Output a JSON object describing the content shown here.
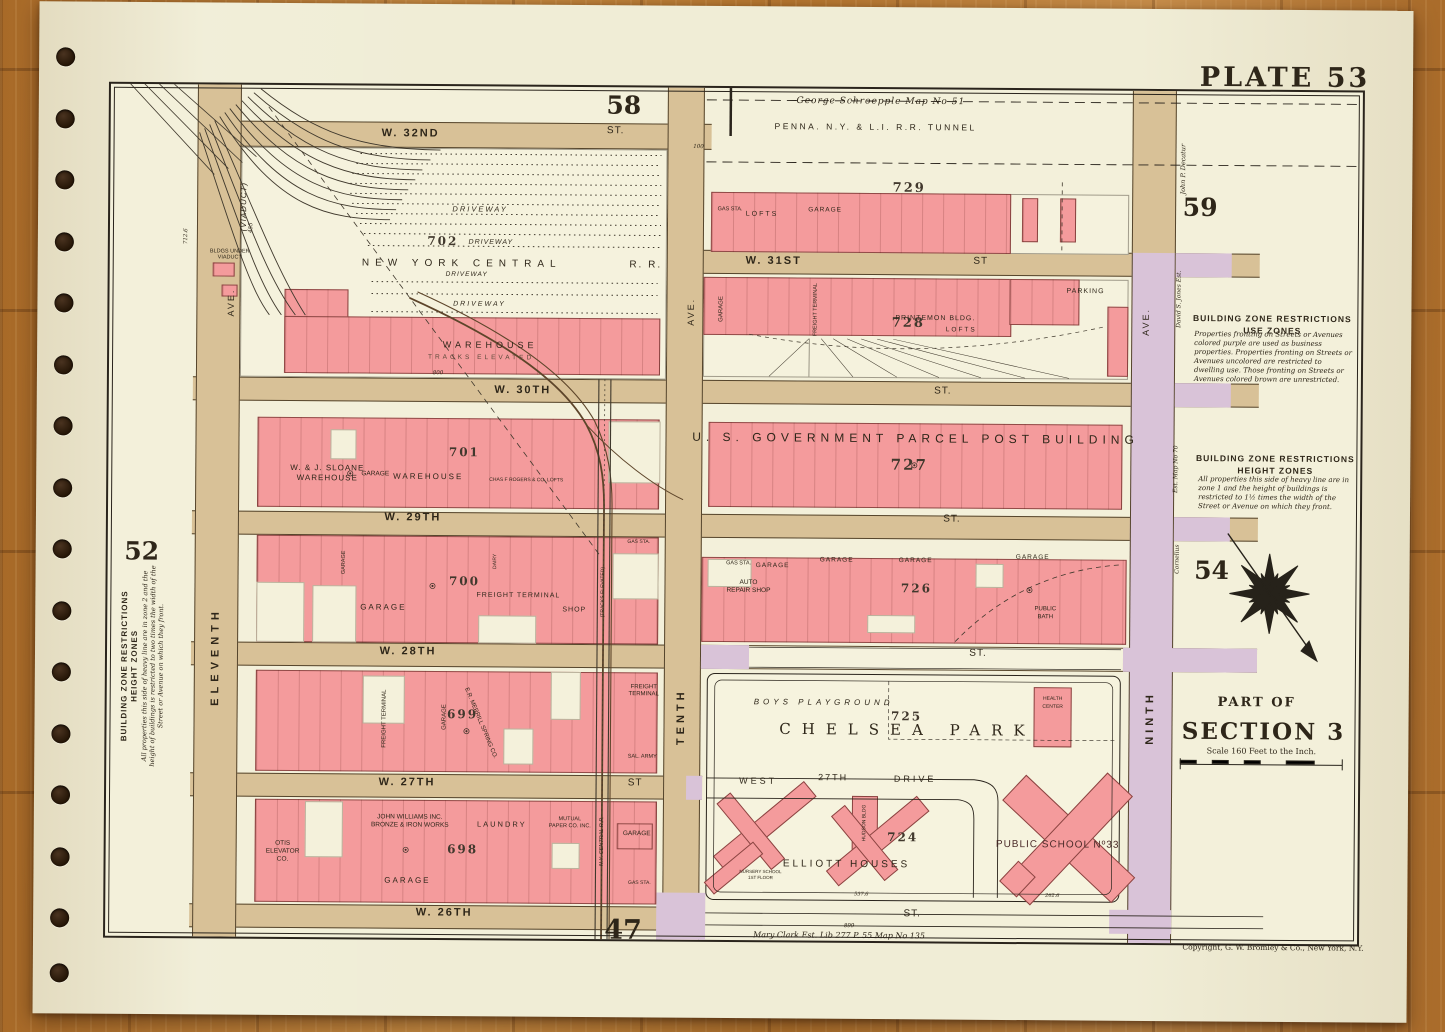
{
  "colors": {
    "paper": "#f0edd6",
    "pink": "#f49b9c",
    "tan": "#d8c197",
    "purple": "#d9c3d8",
    "ink": "#2a241c",
    "wood": "#b5762f"
  },
  "plate": {
    "title": "PLATE 53",
    "copyright": "Copyright, G. W. Bromley & Co., New York, N.Y."
  },
  "adjacent": {
    "top": "58",
    "topright": "59",
    "left": "52",
    "right": "54",
    "bottom": "47"
  },
  "margin": {
    "schroepple": "George Schroepple Map No 51",
    "tunnel": "PENNA. N.Y. & L.I. R.R. TUNNEL",
    "maryclark": "Mary Clark Est. Lib 277 P. 55 Map No 135",
    "decatur": "John P. Decatur",
    "jones": "David S. Jones Est.",
    "cornelius": "Cornelius",
    "estmap": "Est. Map No 70"
  },
  "zones": {
    "use": {
      "t1": "BUILDING ZONE RESTRICTIONS",
      "t2": "USE ZONES",
      "body": "Properties fronting on Streets or Avenues colored purple are used as business properties. Properties fronting on Streets or Avenues uncolored are restricted to dwelling use. Those fronting on Streets or Avenues colored brown are unrestricted."
    },
    "height": {
      "t1": "BUILDING ZONE RESTRICTIONS",
      "t2": "HEIGHT ZONES",
      "body": "All properties this side of heavy line are in zone 1 and the height of buildings is restricted to 1½ times the width of the Street or Avenue on which they front."
    },
    "left": {
      "t1": "BUILDING ZONE RESTRICTIONS",
      "t2": "HEIGHT ZONES",
      "body": "All properties this side of heavy line are in zone 2 and the height of buildings is restricted to two times the width of the Street or Avenue on which they front."
    }
  },
  "section": {
    "partof": "PART OF",
    "name": "SECTION 3",
    "scale": "Scale 160 Feet to the Inch."
  },
  "streets": {
    "w32": "W. 32ND",
    "w31": "W. 31ST",
    "w30": "W. 30TH",
    "w29": "W. 29TH",
    "w28": "W. 28TH",
    "w27": "W. 27TH",
    "w26": "W. 26TH",
    "st": "ST.",
    "st2": "ST"
  },
  "aves": {
    "eleventh": "ELEVENTH",
    "tenth": "TENTH",
    "ninth": "NINTH",
    "ave": "AVE.",
    "viaduct": "(VIADUCT)"
  },
  "yard": {
    "num": "702",
    "rr1": "NEW YORK CENTRAL",
    "rr2": "R. R.",
    "driveway": "DRIVEWAY",
    "warehouse": "WAREHOUSE",
    "tracks": "TRACKS ELEVATED",
    "bldgs": "BLDGS UNDER VIADUCT"
  },
  "b729": {
    "num": "729",
    "gas": "GAS STA.",
    "lofts": "LOFTS",
    "garage": "GARAGE"
  },
  "b728": {
    "num": "728",
    "garage": "GARAGE",
    "freight": "FREIGHT TERMINAL",
    "printemon": "PRINTEMON BLDG.",
    "lofts": "LOFTS",
    "parking": "PARKING"
  },
  "b727": {
    "num": "727",
    "name": "U. S. GOVERNMENT PARCEL POST BUILDING"
  },
  "b701": {
    "num": "701",
    "sloane1": "W. & J. SLOANE",
    "sloane2": "WAREHOUSE",
    "garage": "GARAGE",
    "warehouse": "WAREHOUSE",
    "rogers": "CHAS F ROGERS & CO. LOFTS"
  },
  "b700": {
    "num": "700",
    "garage1": "GARAGE",
    "garage2": "GARAGE",
    "dairy": "DAIRY",
    "freight": "FREIGHT TERMINAL",
    "shop": "SHOP",
    "gas": "GAS STA.",
    "tracks": "(TRACKS ELEVATED)"
  },
  "b726": {
    "num": "726",
    "gas": "GAS STA.",
    "auto1": "AUTO",
    "auto2": "REPAIR SHOP",
    "garage": "GARAGE",
    "bath1": "PUBLIC",
    "bath2": "BATH"
  },
  "b699": {
    "num": "699",
    "freight": "FREIGHT TERMINAL",
    "garage": "GARAGE",
    "merrill": "E.R. MERRILL SPRING CO.",
    "freight2": "FREIGHT TERMINAL",
    "sal": "SAL. ARMY"
  },
  "park": {
    "num": "725",
    "name": "CHELSEA PARK",
    "playground": "BOYS PLAYGROUND",
    "health1": "HEALTH",
    "health2": "CENTER",
    "west": "WEST",
    "d27": "27TH",
    "drive": "DRIVE"
  },
  "b724": {
    "num": "724",
    "elliott": "ELLIOTT HOUSES",
    "school": "PUBLIC SCHOOL Nº33",
    "hudson": "HUDSON BLDG",
    "nursery1": "NURSERY SCHOOL",
    "nursery2": "1ST FLOOR"
  },
  "b698": {
    "num": "698",
    "otis1": "OTIS",
    "otis2": "ELEVATOR",
    "otis3": "CO.",
    "williams1": "JOHN WILLIAMS INC.",
    "williams2": "BRONZE & IRON WORKS",
    "laundry": "LAUNDRY",
    "mutual1": "MUTUAL",
    "mutual2": "PAPER CO. INC.",
    "garage": "GARAGE",
    "garage2": "GARAGE",
    "gas": "GAS STA.",
    "rr": "N.Y. CENTRAL R.R."
  },
  "nums": {
    "n455": "455",
    "n100": "100",
    "n800": "800",
    "n899": "899",
    "n5376": "537.6",
    "n2626": "262.6",
    "n7126": "712.6"
  }
}
